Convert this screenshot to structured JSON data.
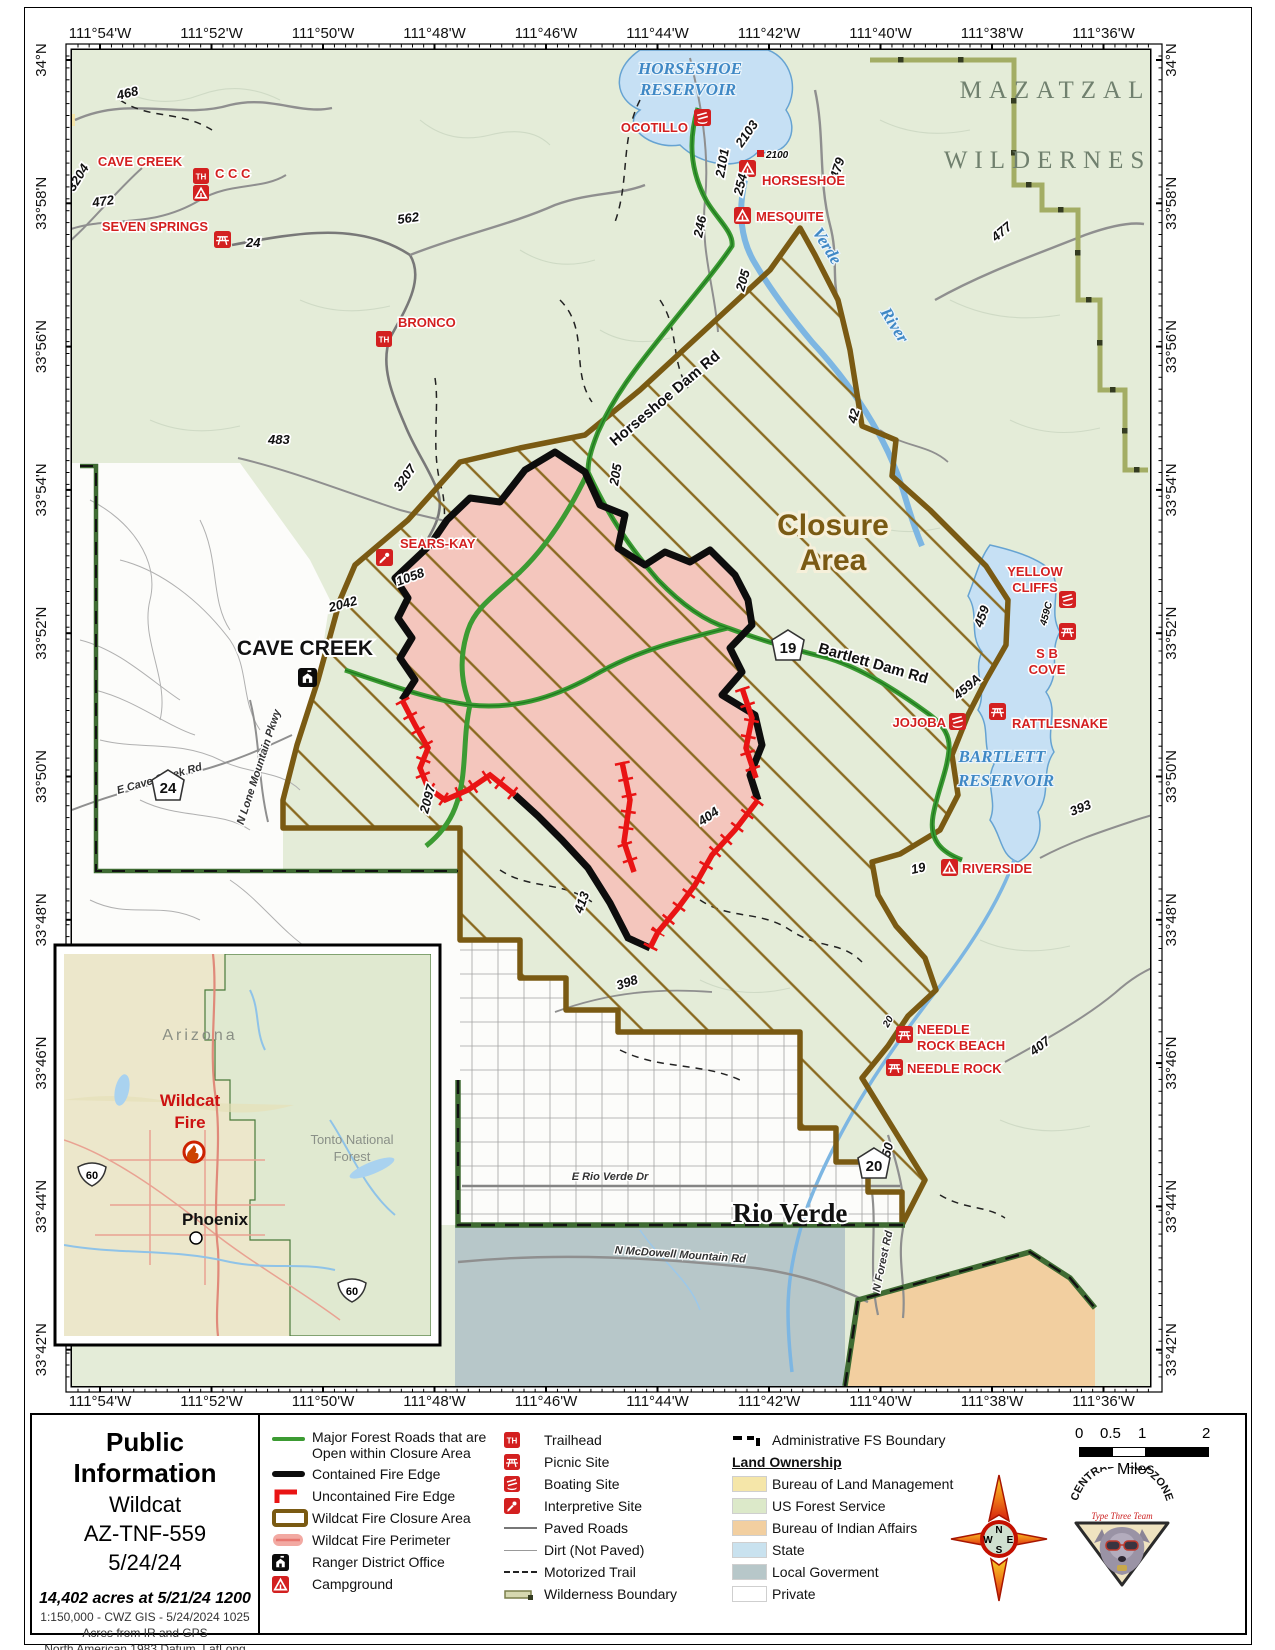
{
  "frame": {
    "coords_top": [
      "111°54'W",
      "111°52'W",
      "111°50'W",
      "111°48'W",
      "111°46'W",
      "111°44'W",
      "111°42'W",
      "111°40'W",
      "111°38'W",
      "111°36'W"
    ],
    "coords_lat": [
      "34°N",
      "33°58'N",
      "33°56'N",
      "33°54'N",
      "33°52'N",
      "33°50'N",
      "33°48'N",
      "33°46'N",
      "33°44'N",
      "33°42'N"
    ]
  },
  "map": {
    "areas": {
      "mazatzal_1": "MAZATZAL",
      "mazatzal_2": "WILDERNESS",
      "closure_1": "Closure",
      "closure_2": "Area"
    },
    "water": {
      "horseshoe_1": "HORSESHOE",
      "horseshoe_2": "RESERVOIR",
      "verde": "Verde",
      "river": "River",
      "bartlett_1": "BARTLETT",
      "bartlett_2": "RESERVOIR"
    },
    "towns": {
      "cave_creek": "CAVE CREEK",
      "rio_verde": "Rio Verde"
    },
    "pois": {
      "ocotillo": "OCOTILLO",
      "horseshoe": "HORSESHOE",
      "mesquite": "MESQUITE",
      "cave_creek": "CAVE CREEK",
      "ccc": "C C C",
      "seven_springs": "SEVEN SPRINGS",
      "bronco": "BRONCO",
      "sears_kay": "SEARS-KAY",
      "yellow_cliffs_1": "YELLOW",
      "yellow_cliffs_2": "CLIFFS",
      "sb_cove_1": "S B",
      "sb_cove_2": "COVE",
      "rattlesnake": "RATTLESNAKE",
      "jojoba": "JOJOBA",
      "riverside": "RIVERSIDE",
      "needle_rock_beach_1": "NEEDLE",
      "needle_rock_beach_2": "ROCK BEACH",
      "needle_rock": "NEEDLE ROCK"
    },
    "roads": {
      "horseshoe_dam": "Horseshoe Dam Rd",
      "bartlett_dam": "Bartlett Dam Rd",
      "e_rio_verde": "E Rio Verde Dr",
      "e_cave_creek": "E Cave Creek Rd",
      "n_lone_mountain": "N Lone Mountain Pkwy",
      "n_forest": "N Forest Rd",
      "n_mcdowell": "N McDowell Mountain Rd"
    },
    "road_numbers": {
      "n468": "468",
      "n472": "472",
      "n3204": "3204",
      "n254": "254",
      "n562": "562",
      "n483": "483",
      "n3207": "3207",
      "n24": "24",
      "n246": "246",
      "n205a": "205",
      "n205b": "205",
      "n2103": "2103",
      "n2101": "2101",
      "n2100": "2100",
      "n479": "479",
      "n477": "477",
      "n42": "42",
      "n459": "459",
      "n459c": "459C",
      "n459a": "459A",
      "n393": "393",
      "n404": "404",
      "n2097": "2097",
      "n413": "413",
      "n398": "398",
      "n407": "407",
      "n2150": "2150",
      "n1058": "1058",
      "n2042": "2042",
      "n19": "19",
      "n20": "20"
    },
    "shields": {
      "s24": "24",
      "s19": "19",
      "s20": "20"
    }
  },
  "inset": {
    "labels": {
      "arizona": "Arizona",
      "wildcat_1": "Wildcat",
      "wildcat_2": "Fire",
      "tonto_1": "Tonto National",
      "tonto_2": "Forest",
      "phoenix": "Phoenix"
    },
    "shield_60": "60"
  },
  "title_panel": {
    "title": "Public Information",
    "fire_name": "Wildcat",
    "incident_number": "AZ-TNF-559",
    "date": "5/24/24",
    "acres": "14,402 acres at 5/21/24 1200",
    "scale_note": "1:150,000 - CWZ GIS - 5/24/2024 1025",
    "acres_note": "Acres from IR and GPS",
    "datum_note": "North American 1983 Datum. LatLong"
  },
  "legend": {
    "col1": {
      "roads_open_1": "Major Forest Roads that are Open",
      "roads_open_2": "within Closure Area",
      "contained": "Contained Fire Edge",
      "uncontained": "Uncontained Fire Edge",
      "closure": "Wildcat Fire Closure Area",
      "perimeter": "Wildcat Fire Perimeter",
      "ranger": "Ranger District Office",
      "campground": "Campground"
    },
    "col2": {
      "trailhead": "Trailhead",
      "picnic": "Picnic Site",
      "boating": "Boating Site",
      "interpretive": "Interpretive Site",
      "paved": "Paved Roads",
      "dirt": "Dirt (Not Paved)",
      "motorized": "Motorized Trail",
      "wilderness": "Wilderness Boundary"
    },
    "col3": {
      "admin": "Administrative FS Boundary",
      "land_ownership": "Land Ownership",
      "blm": "Bureau of Land Management",
      "usfs": "US Forest Service",
      "bia": "Bureau of Indian Affairs",
      "state": "State",
      "local": "Local Goverment",
      "private": "Private"
    }
  },
  "scale_bar": {
    "t0": "0",
    "t05": "0.5",
    "t1": "1",
    "t2": "2",
    "unit": "Miles"
  },
  "compass": {
    "n": "N",
    "e": "E",
    "s": "S",
    "w": "W"
  },
  "logo": {
    "arc": "CENTRAL WEST ZONE",
    "sub": "Type Three Team"
  },
  "colors": {
    "usfs_green": "#e4ecd8",
    "water": "#c6e0f4",
    "closure_brown": "#7a5a13",
    "fire_pink": "#f4c6bd",
    "fire_red": "#e91414",
    "road_green": "#3c9b33",
    "blm_yellow": "#f5e6a9",
    "bia_orange": "#f2cfa0",
    "state_blue": "#c9e2ef",
    "local_gray": "#b7c7c9",
    "wilderness_olive": "#a3ad64",
    "poi_red": "#d32020"
  }
}
